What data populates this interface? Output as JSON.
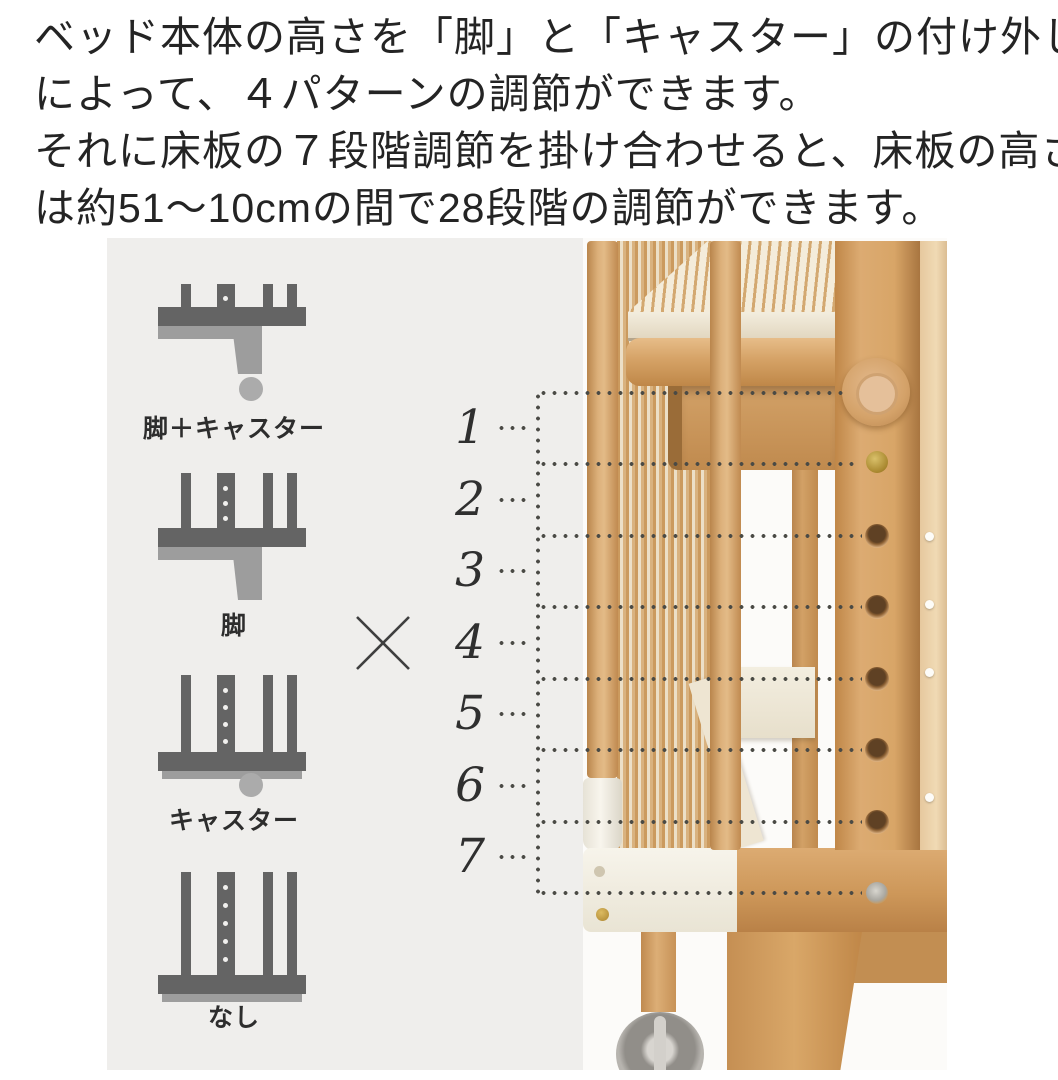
{
  "intro": {
    "lines": [
      "ベッド本体の高さを「脚」と「キャスター」の付け外し",
      "によって、４パターンの調節ができます。",
      "それに床板の７段階調節を掛け合わせると、床板の高さ",
      "は約51～10cmの間で28段階の調節ができます。"
    ]
  },
  "diagram": {
    "patterns": [
      {
        "label": "脚＋キャスター",
        "has_leg": true,
        "has_caster": true
      },
      {
        "label": "脚",
        "has_leg": true,
        "has_caster": false
      },
      {
        "label": "キャスター",
        "has_leg": false,
        "has_caster": true
      },
      {
        "label": "なし",
        "has_leg": false,
        "has_caster": false
      }
    ],
    "multiply_symbol": "×",
    "scale_levels": [
      "1",
      "2",
      "3",
      "4",
      "5",
      "6",
      "7"
    ]
  },
  "colors": {
    "panel_bg": "#efeeec",
    "icon_dark": "#646464",
    "icon_light": "#9d9d9d",
    "dot_line": "#4a4a45",
    "wood_main": "#d5a266",
    "wood_dark": "#b9854c",
    "white_part": "#f4f1e9",
    "text": "#242424"
  }
}
